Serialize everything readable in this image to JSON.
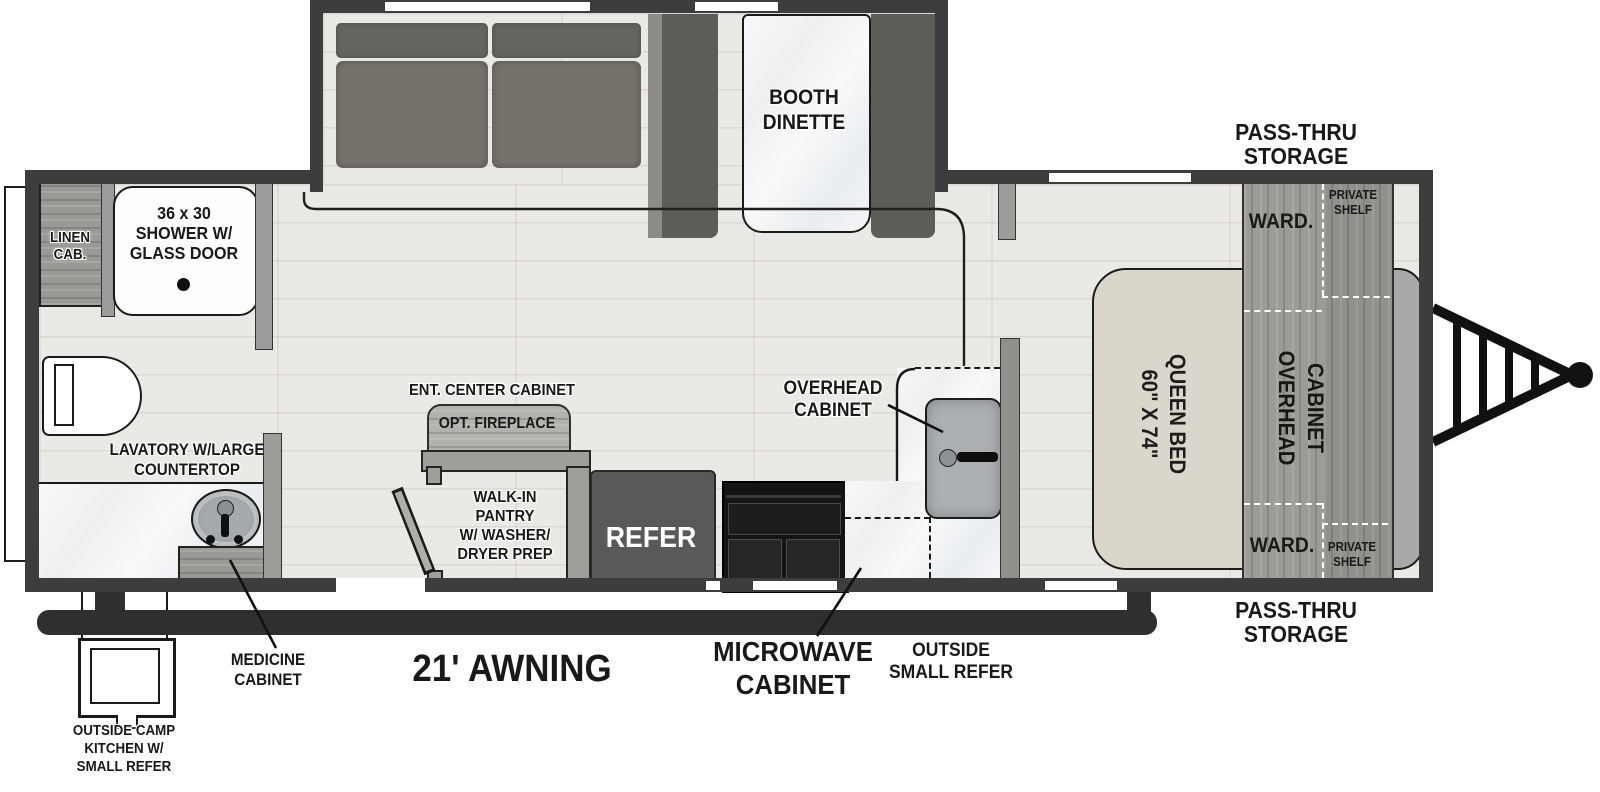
{
  "diagram": {
    "slide_out": {
      "dinette": {
        "lines": [
          "BOOTH",
          "DINETTE"
        ]
      }
    },
    "bathroom": {
      "linen_cab": {
        "lines": [
          "LINEN",
          "CAB."
        ]
      },
      "shower": {
        "lines": [
          "36 x 30",
          "SHOWER W/",
          "GLASS DOOR"
        ]
      },
      "lavatory": {
        "lines": [
          "LAVATORY W/LARGE",
          "COUNTERTOP"
        ]
      },
      "medicine_cabinet": {
        "lines": [
          "MEDICINE",
          "CABINET"
        ]
      }
    },
    "living": {
      "ent_center": {
        "label": "ENT. CENTER CABINET",
        "fireplace": "OPT. FIREPLACE"
      },
      "pantry": {
        "lines": [
          "WALK-IN",
          "PANTRY",
          "W/ WASHER/",
          "DRYER PREP"
        ]
      }
    },
    "kitchen": {
      "refer": "REFER",
      "overhead_cabinet": {
        "lines": [
          "OVERHEAD",
          "CABINET"
        ]
      },
      "microwave_cabinet": {
        "lines": [
          "MICROWAVE",
          "CABINET"
        ]
      },
      "outside_small_refer": {
        "lines": [
          "OUTSIDE",
          "SMALL REFER"
        ]
      }
    },
    "bedroom": {
      "bed": {
        "size": "60\" X 74\"",
        "name": "QUEEN BED"
      },
      "overhead_cabinet": {
        "word1": "OVERHEAD",
        "word2": "CABINET"
      },
      "ward_top": "WARD.",
      "ward_bottom": "WARD.",
      "private_shelf_top": {
        "lines": [
          "PRIVATE",
          "SHELF"
        ]
      },
      "private_shelf_bottom": {
        "lines": [
          "PRIVATE",
          "SHELF"
        ]
      },
      "pass_thru_top": {
        "lines": [
          "PASS-THRU",
          "STORAGE"
        ]
      },
      "pass_thru_bottom": {
        "lines": [
          "PASS-THRU",
          "STORAGE"
        ]
      }
    },
    "exterior": {
      "awning": "21' AWNING",
      "camp_kitchen": {
        "lines": [
          "OUTSIDE CAMP",
          "KITCHEN W/",
          "SMALL REFER"
        ]
      }
    },
    "colors": {
      "wall": "#3d3d3d",
      "floor": "#ebe9e5",
      "marble": "#f3f4f6",
      "wood_cabinet": "#9d9b96",
      "sofa": "#6f6d65",
      "dinette_bench": "#5e5c56",
      "bed": "#dad6cb",
      "refrigerator": "#595959",
      "range": "#161616",
      "dash_on_wood": "#ffffff",
      "dash_on_counter": "#1a1a1a",
      "outline": "#1a1a1a"
    }
  }
}
